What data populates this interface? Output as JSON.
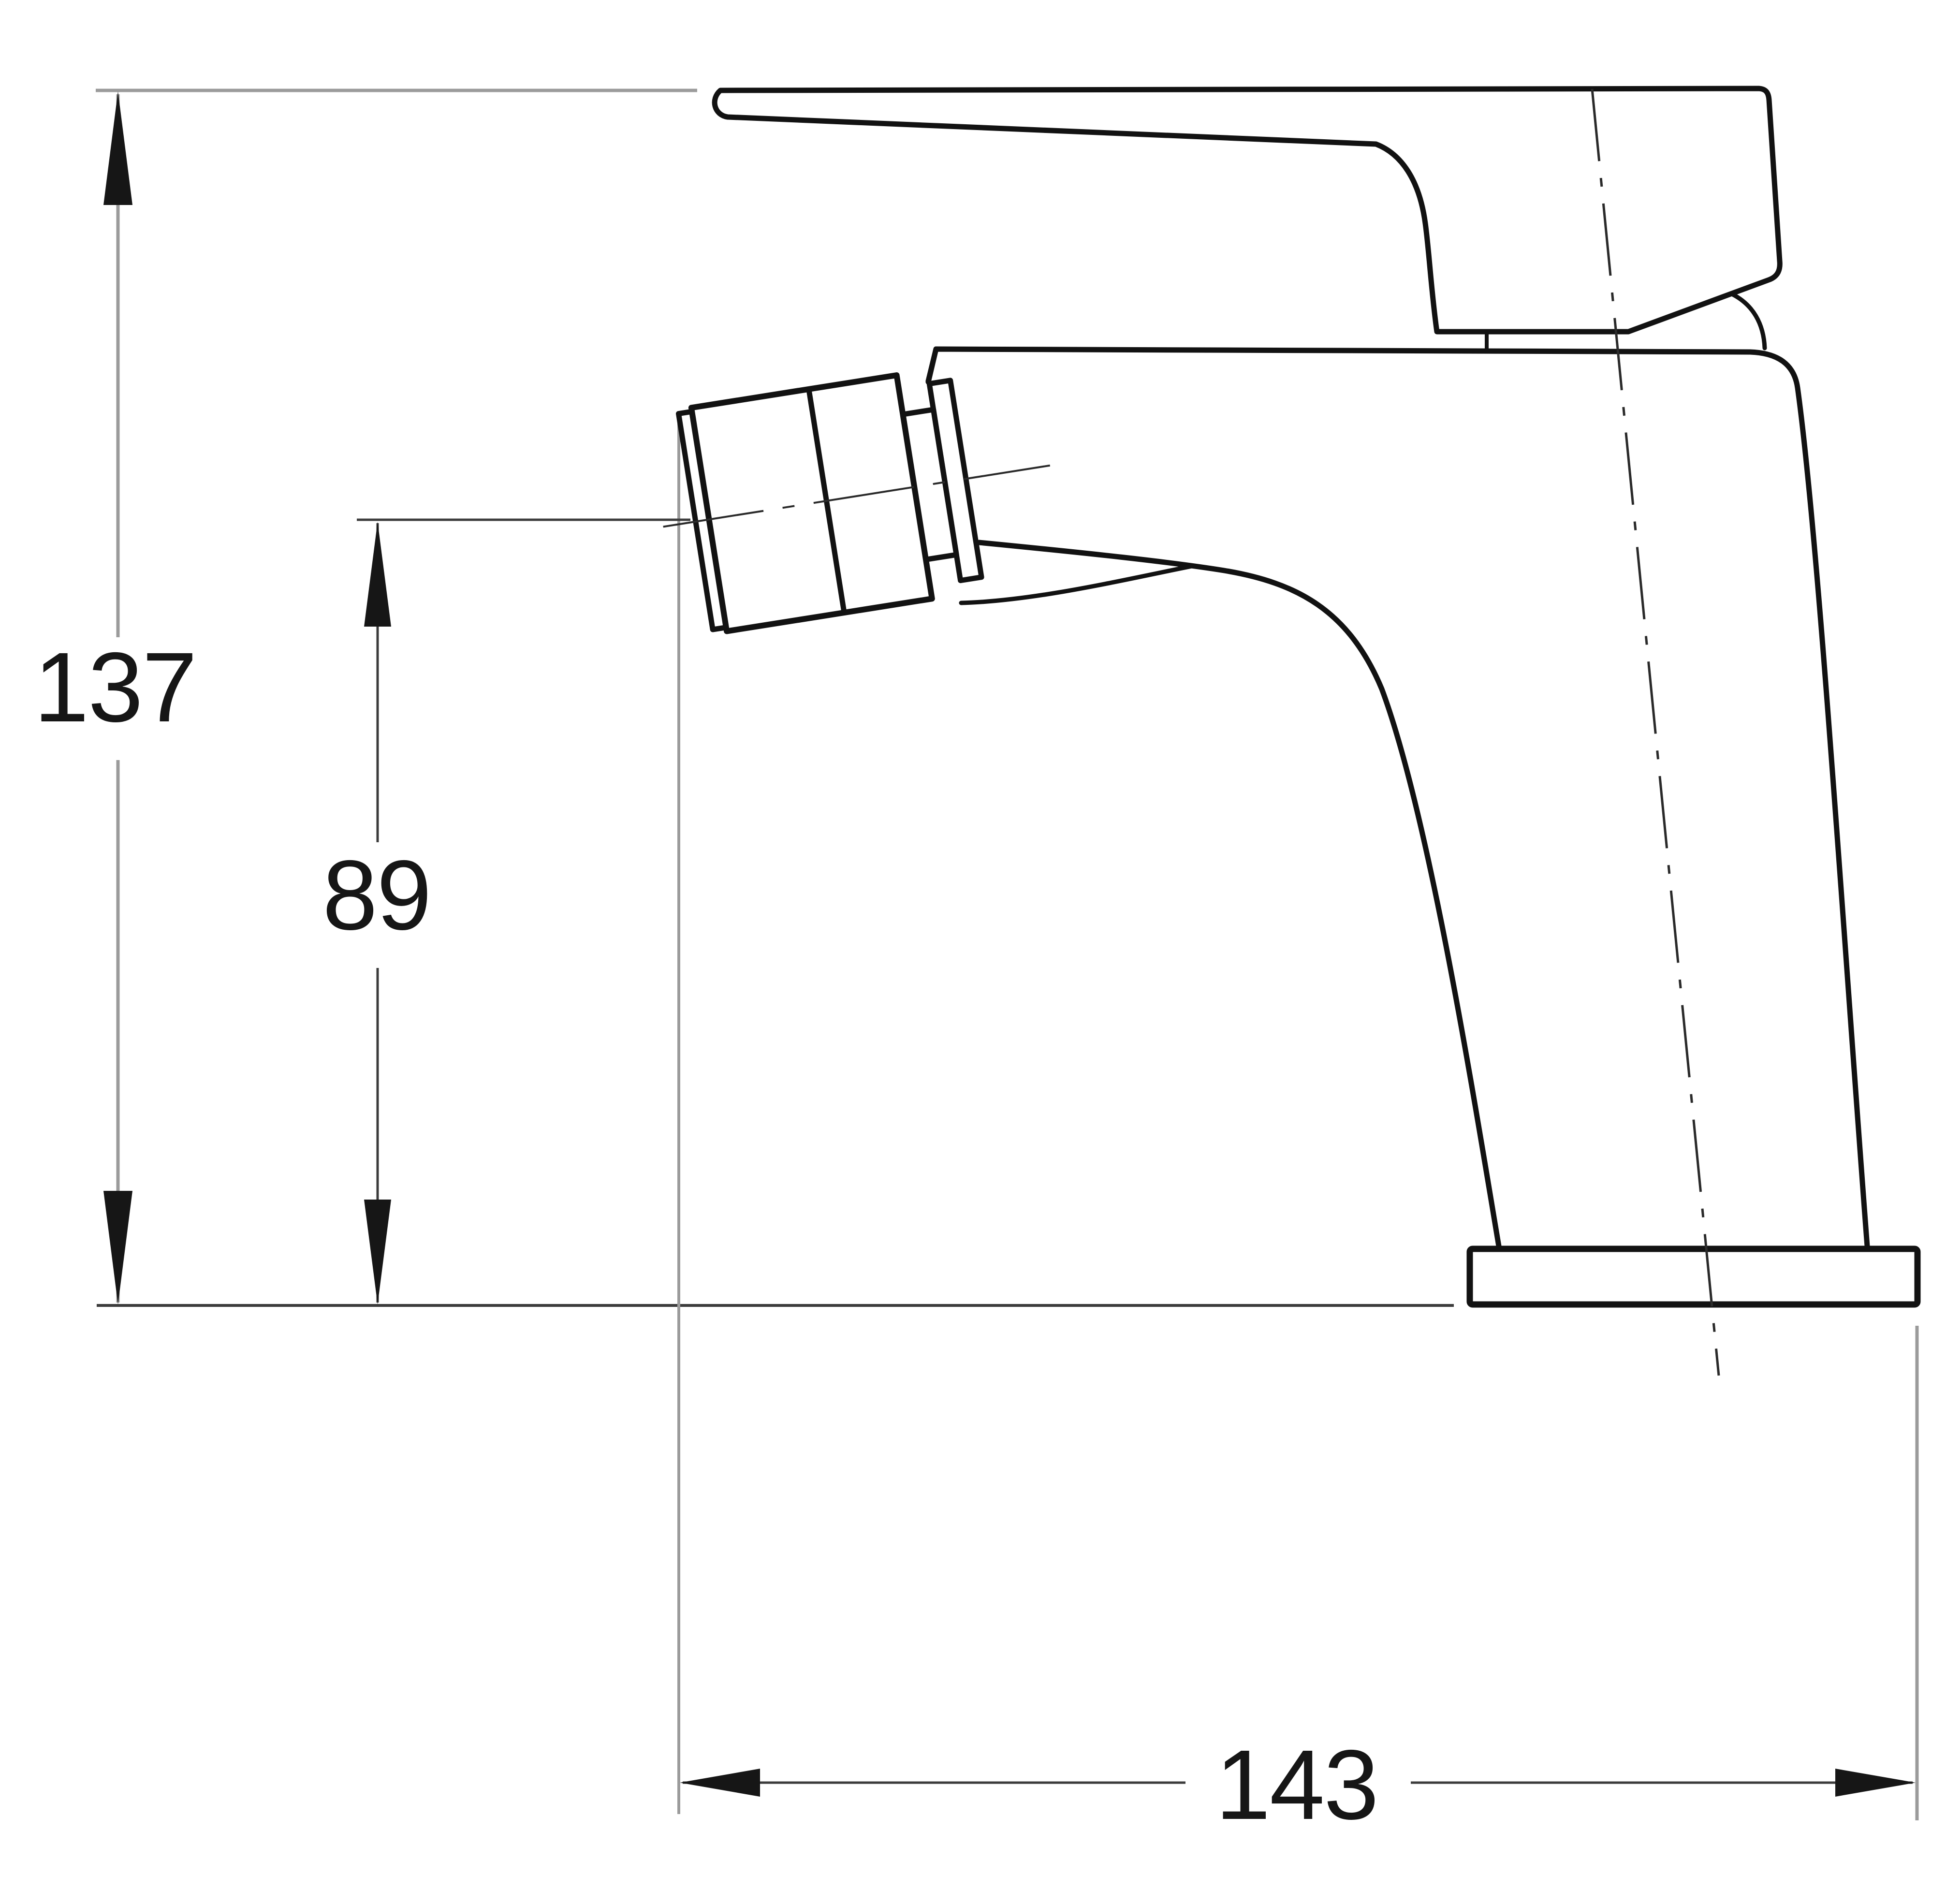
{
  "drawing": {
    "type": "technical-dimension-drawing",
    "view": "side elevation of a single-lever basin/bidet mixer tap",
    "dimension_labels": {
      "overall_height": "137",
      "spout_height": "89",
      "overall_depth": "143"
    },
    "colors": {
      "background": "#ffffff",
      "outline": "#121212",
      "dimension_line_gray": "#9b9b9b",
      "dimension_line_dark": "#3c3c3c",
      "text": "#161616"
    }
  }
}
